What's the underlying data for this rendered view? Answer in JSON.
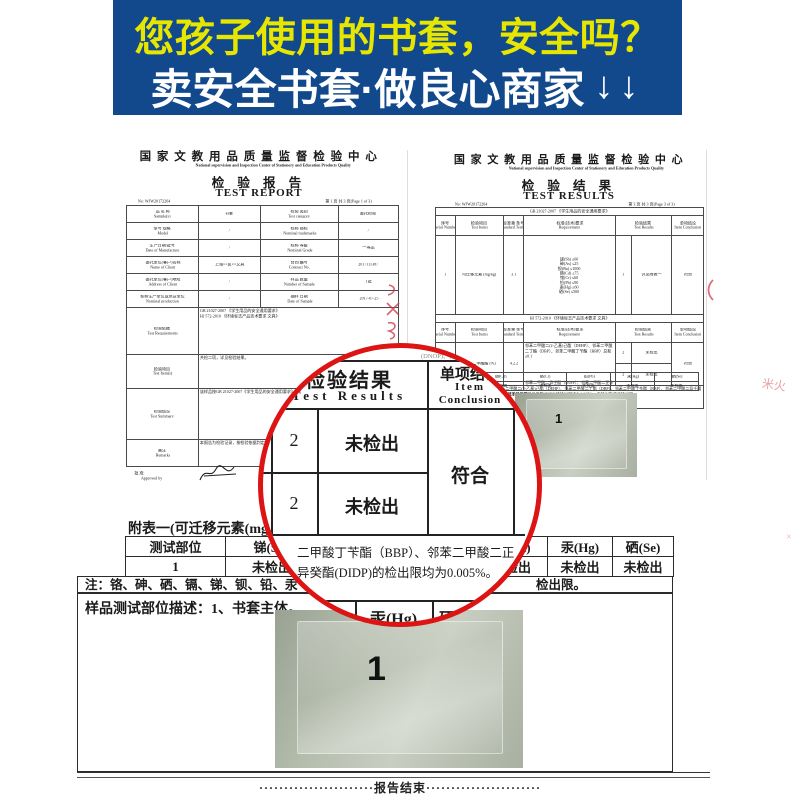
{
  "banner": {
    "line1": "您孩子使用的书套，安全吗？",
    "line2": "卖安全书套·做良心商家",
    "arrows": "↓↓",
    "bg_color": "#12498c",
    "line1_color": "#e6e600",
    "line2_color": "#ffffff"
  },
  "center": {
    "name_cn": "国 家 文 教 用 品 质 量 监 督 检 验 中 心",
    "name_en": "National supervision and Inspection Center of Stationery and Education Products Quality"
  },
  "left_report": {
    "title_cn": "检 验 报 告",
    "title_en": "TEST REPORT",
    "no": "No: WJW20172264",
    "page": "第 1 页 共 3 页(Page 1 of 3)",
    "info_rows": [
      {
        "l1": "品 名 称",
        "l1e": "Sample(s)",
        "v1": "书套",
        "l2": "检验 类别",
        "l2e": "Test category",
        "v2": "委托检验"
      },
      {
        "l1": "型号 规格",
        "l1e": "Model",
        "v1": "/",
        "l2": "标称 商标",
        "l2e": "Nominal trademarks",
        "v2": "/"
      },
      {
        "l1": "生产日期/批号",
        "l1e": "Date of Manufacture",
        "v1": "/",
        "l2": "标称 等级",
        "l2e": "Nominal Grade",
        "v2": "一等品"
      },
      {
        "l1": "委托单位(客户)名称",
        "l1e": "Name of Client",
        "v1": "上海××区××文具",
        "l2": "合同 编号",
        "l2e": "Contract No.",
        "v2": "2017111387"
      },
      {
        "l1": "委托单位(客户)地址",
        "l1e": "Address of Client",
        "v1": "/",
        "l2": "样品 数量",
        "l2e": "Number of Sample",
        "v2": "1批"
      },
      {
        "l1": "标称生产单位或供货单位",
        "l1e": "Nominal production",
        "v1": "/",
        "l2": "抽样 日期",
        "l2e": "Date of Sample",
        "v2": "2017-07-25"
      }
    ],
    "wide_rows": [
      {
        "label": "检验依据",
        "label_en": "Test Requirements",
        "value": "GB 21027-2007 《学生用品的安全通用要求》\nHJ 572-2010 《环境标志产品技术要求 文具》"
      },
      {
        "label": "检验项目",
        "label_en": "Test Item(s)",
        "value": "共检二项，详见检验结果。"
      },
      {
        "label": "检验结论",
        "label_en": "Test Summary",
        "value": "该样品按GB 21027-2007《学生用品的安全通用要求》《环境标志产品技术要求 文具》标准检验，符合要求。"
      },
      {
        "label": "备注",
        "label_en": "Remarks",
        "value": "本报告为检验记录，按检验依据判定符合要求。"
      }
    ],
    "approved_cn": "批 准:",
    "approved_en": "Approved by",
    "verified_cn": "审 核:",
    "verified_en": "Verified by"
  },
  "right_report": {
    "title_cn": "检 验 结 果",
    "title_en": "TEST RESULTS",
    "no": "No: WJW20172264",
    "page": "第 3 页 共 3 页(Page 3 of 3)",
    "standard1": "GB 21027-2007 《学生用品的安全通用要求》",
    "standard2": "HJ 572-2010 《环境标志产品技术要求 文具》",
    "col_headers": [
      {
        "cn": "序号",
        "en": "Serial Number"
      },
      {
        "cn": "检验项目",
        "en": "Test Items"
      },
      {
        "cn": "标准章 条号",
        "en": "Standard Terms"
      },
      {
        "cn": "标准(技术)要求",
        "en": "Requirement"
      },
      {
        "cn": "检验结果",
        "en": "Test Results"
      },
      {
        "cn": "单项结论",
        "en": "Item Conclusion"
      }
    ],
    "row1": {
      "no": "1",
      "item": "可迁移元素 (mg/kg)",
      "clause": "3.1",
      "requirement": "锑(Sb) ≤60\n砷(As) ≤25\n钡(Ba) ≤1000\n镉(Cd) ≤75\n铬(Cr) ≤60\n铅(Pb) ≤90\n汞(Hg) ≤60\n硒(Se) ≤500",
      "result_no": "1",
      "result": "详见附表一",
      "conclusion": "符合"
    },
    "row2": {
      "no": "2",
      "item": "邻苯二甲酸酯 (%)",
      "clause": "4.2.2",
      "req_a": "邻苯二甲酸二(2-乙基)己酯（DEHP）、邻苯二甲酸二丁酯（DBP）、邻苯二甲酸丁苄酯（BBP）总和≤0.1",
      "req_b": "邻苯二甲酸二异壬酯（DINP）、邻苯二甲酸二正辛酯（DNOP）、邻苯二甲酸二异癸酯（DIDP）总和≤0.1",
      "results": [
        {
          "no": "2",
          "val": "未检出"
        },
        {
          "no": "2",
          "val": "未检出"
        }
      ],
      "conclusion": "符合"
    },
    "footnote": "注：报告编号WJW20172264 1-3。邻苯二甲酸二(2-乙基)己酯（DEHP）、邻苯二甲酸二丁酯（DBP）、邻苯二甲酸丁苄酯（BBP）、邻苯二甲酸二异壬酯(DINP)、邻苯二甲酸二正辛酯(DNOP)、邻苯二甲酸二异癸酯(DIDP)的检出限均为0.005%，未检出指低于检出限。",
    "appendix_headers": [
      "钡(Ba)",
      "镉(Cd)",
      "铬(Cr)",
      "铅(Pb)",
      "汞(Hg)",
      "硒(Se)"
    ],
    "appendix_values": [
      "未检出",
      "未检出",
      "未检出",
      "未检出",
      "未检出",
      "未检出"
    ],
    "appendix_note": "注：表中结果单位为mg/kg，“未检出”为低于检出限。",
    "photo_label": "1"
  },
  "magnifier": {
    "result_cn": "检验结果",
    "result_en": "Test Results",
    "conclusion_cn": "单项结论",
    "conclusion_en1": "Item",
    "conclusion_en2": "Conclusion",
    "rows": [
      {
        "no": "2",
        "result": "未检出"
      },
      {
        "no": "2",
        "result": "未检出"
      }
    ],
    "verdict": "符合",
    "note_line1": "二甲酸丁苄酯（BBP）、邻苯二甲酸二正",
    "note_line2": "异癸酯(DIDP)的检出限均为0.005%。",
    "hg_cell": "汞(Hg)",
    "se_partial": "硒",
    "ghost_top": "(DNOP)、(DIDP) 总和≤0.1",
    "ring_color": "#dd1414"
  },
  "appendix": {
    "title": "附表一(可迁移元素(mg/kg))",
    "headers": [
      "测试部位",
      "锑(Sb)",
      "砷(As)",
      "钡(Ba)",
      "镉(Cd)",
      "汞(Hg)",
      "硒(Se)"
    ],
    "row": [
      "1",
      "未检出",
      "未检出",
      "未检出",
      "未检出",
      "未检出",
      "未检出"
    ],
    "note_left": "注：铬、砷、硒、镉、锑、钡、铅、汞",
    "note_right": "检出限。",
    "sample_desc": "样品测试部位描述：1、书套主体。",
    "photo_label": "1"
  },
  "footer": {
    "leader": "·······················",
    "end_text": "报告结束"
  }
}
